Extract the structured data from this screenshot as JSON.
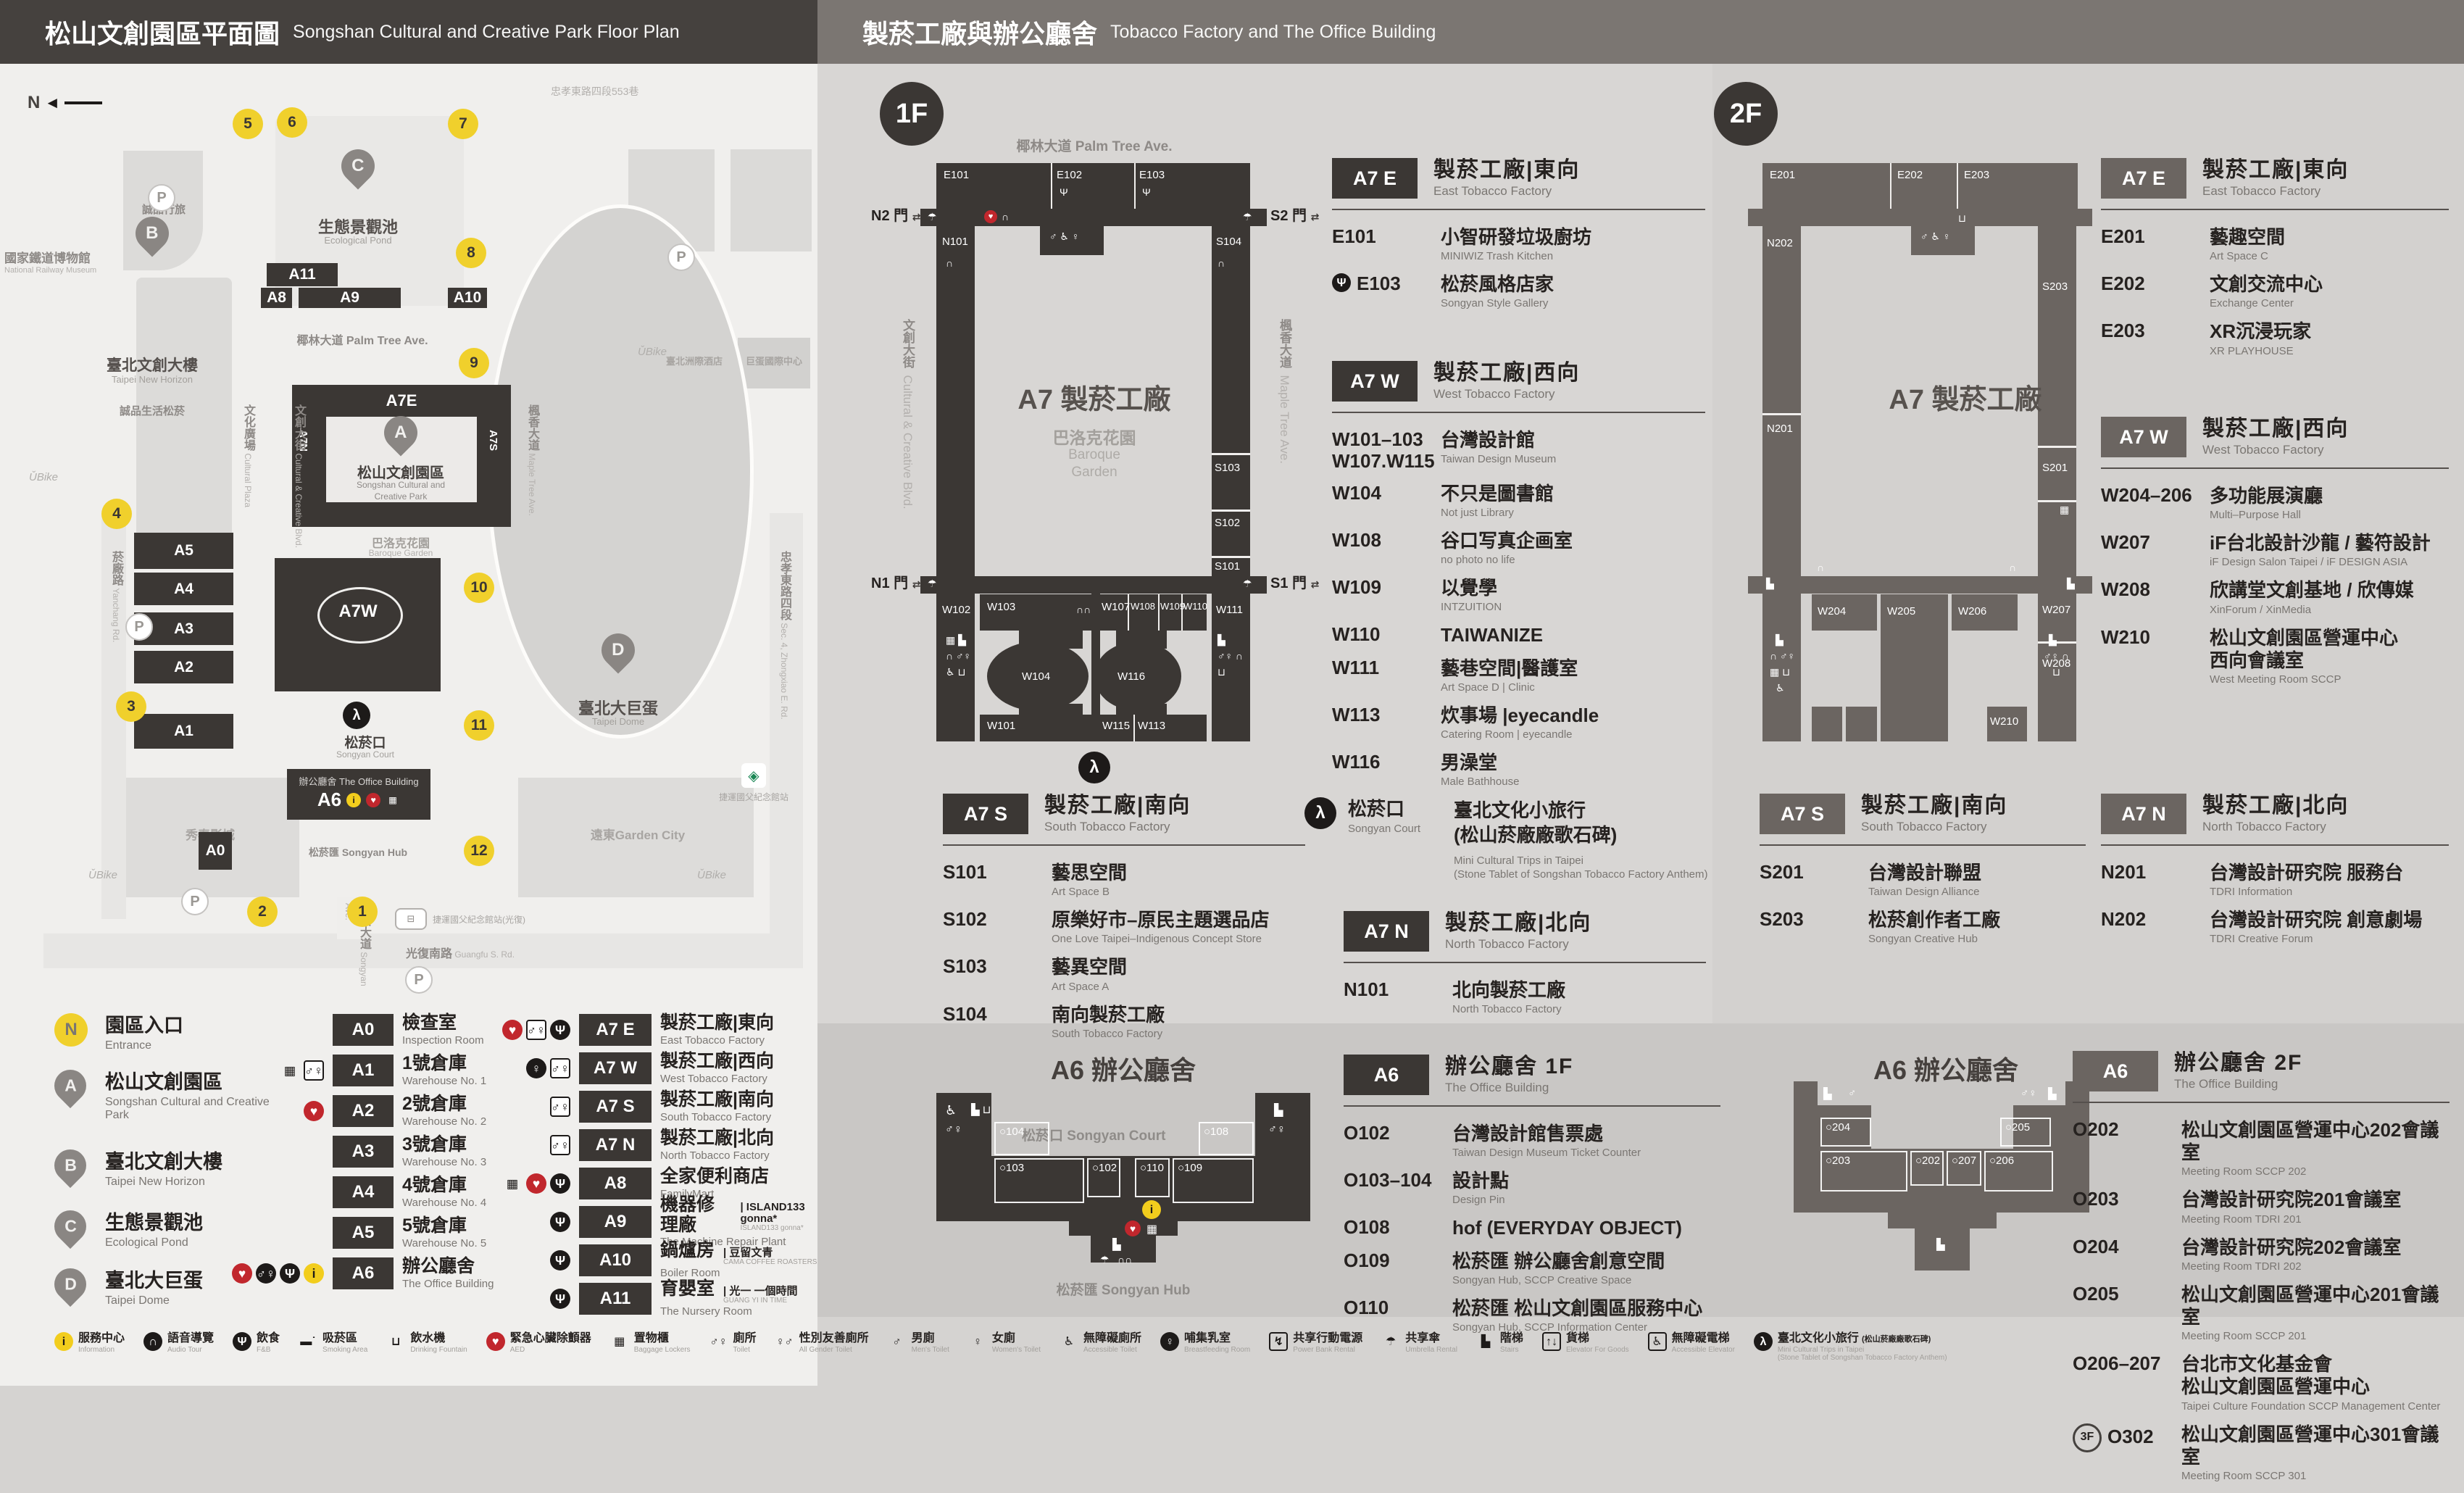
{
  "header_left": {
    "zh": "松山文創園區平面圖",
    "en": "Songshan Cultural and Creative Park Floor Plan"
  },
  "header_right": {
    "zh": "製菸工廠與辦公廳舍",
    "en": "Tobacco Factory and The Office Building"
  },
  "park_map": {
    "compass": "N",
    "entrances": [
      "1",
      "2",
      "3",
      "4",
      "5",
      "6",
      "7",
      "8",
      "9",
      "10",
      "11",
      "12"
    ],
    "buildings": [
      "A0",
      "A1",
      "A2",
      "A3",
      "A4",
      "A5",
      "A8",
      "A9",
      "A10",
      "A11"
    ],
    "labels": {
      "a7e": "A7E",
      "a7w": "A7W",
      "a6": "A6",
      "a7n": "A7N",
      "a7s": "A7S",
      "palm": "椰林大道 Palm Tree Ave.",
      "park_zh": "松山文創園區",
      "park_en1": "Songshan Cultural and",
      "park_en2": "Creative Park",
      "garden_zh": "巴洛克花園",
      "garden_en": "Baroque Garden",
      "court_zh": "松菸口",
      "court_en": "Songyan Court",
      "office_zh": "辦公廳舍",
      "office_en": "The Office Building",
      "hub_zh": "松菸匯",
      "hub_en": "Songyan Hub",
      "pond_zh": "生態景觀池",
      "pond_en": "Ecological Pond",
      "dome_zh": "臺北大巨蛋",
      "dome_en": "Taipei Dome",
      "new_horizon_zh": "臺北文創大樓",
      "new_horizon_en": "Taipei New Horizon",
      "eslite_spectrum": "誠品生活松菸",
      "eslite_hotel": "誠品行旅",
      "railway_zh": "國家鐵道博物館",
      "railway_en": "National Railway Museum",
      "intercontinental": "臺北洲際酒店",
      "dome_intl": "巨蛋國際中心",
      "showtime": "秀泰影城",
      "garden_city": "遠東Garden City",
      "mrt": "捷運國父紀念館站",
      "bus": "捷運國父紀念館站(光復)",
      "lane553": "忠孝東路四段553巷"
    },
    "streets": [
      {
        "zh": "菸廠路",
        "en": "Yanchang Rd."
      },
      {
        "zh": "文化廣場",
        "en": "Cultural Plaza"
      },
      {
        "zh": "文創大街",
        "en": "Cultural & Creative Blvd."
      },
      {
        "zh": "楓香大道",
        "en": "Maple Tree Ave."
      },
      {
        "zh": "松菸大道",
        "en": "Songyan Ave."
      },
      {
        "zh": "光復南路",
        "en": "Guangfu S. Rd."
      },
      {
        "zh": "忠孝東路四段",
        "en": "Sec. 4, Zhongxiao E. Rd."
      }
    ]
  },
  "legend": {
    "places": [
      {
        "sym": "N",
        "zh": "園區入口",
        "en": "Entrance"
      },
      {
        "sym": "A",
        "zh": "松山文創園區",
        "en": "Songshan Cultural and Creative Park"
      },
      {
        "sym": "B",
        "zh": "臺北文創大樓",
        "en": "Taipei New Horizon"
      },
      {
        "sym": "C",
        "zh": "生態景觀池",
        "en": "Ecological Pond"
      },
      {
        "sym": "D",
        "zh": "臺北大巨蛋",
        "en": "Taipei Dome"
      }
    ],
    "col2": [
      {
        "tile": "A0",
        "zh": "檢查室",
        "en": "Inspection Room",
        "icons": []
      },
      {
        "tile": "A1",
        "zh": "1號倉庫",
        "en": "Warehouse No. 1",
        "icons": [
          "lockers",
          "toilet"
        ]
      },
      {
        "tile": "A2",
        "zh": "2號倉庫",
        "en": "Warehouse No. 2",
        "icons": [
          "aed"
        ]
      },
      {
        "tile": "A3",
        "zh": "3號倉庫",
        "en": "Warehouse No. 3",
        "icons": []
      },
      {
        "tile": "A4",
        "zh": "4號倉庫",
        "en": "Warehouse No. 4",
        "icons": []
      },
      {
        "tile": "A5",
        "zh": "5號倉庫",
        "en": "Warehouse No. 5",
        "icons": []
      },
      {
        "tile": "A6",
        "zh": "辦公廳舍",
        "en": "The Office Building",
        "icons": [
          "aed",
          "toiletDark",
          "fnb",
          "info"
        ]
      }
    ],
    "col3": [
      {
        "tile": "A7 E",
        "zh": "製菸工廠|東向",
        "en": "East Tobacco Factory",
        "icons": [
          "aed",
          "toilet",
          "fnb"
        ]
      },
      {
        "tile": "A7 W",
        "zh": "製菸工廠|西向",
        "en": "West Tobacco Factory",
        "icons": [
          "breastfeeding",
          "toilet"
        ]
      },
      {
        "tile": "A7 S",
        "zh": "製菸工廠|南向",
        "en": "South Tobacco Factory",
        "icons": [
          "toilet"
        ]
      },
      {
        "tile": "A7 N",
        "zh": "製菸工廠|北向",
        "en": "North Tobacco Factory",
        "icons": [
          "toilet"
        ]
      },
      {
        "tile": "A8",
        "zh": "全家便利商店",
        "en": "FamilyMart",
        "icons": [
          "lockers",
          "aed",
          "fnb"
        ]
      },
      {
        "tile": "A9",
        "zh": "機器修理廠",
        "en": "The Machine Repair Plant",
        "partner_zh": "ISLAND133 gonna*",
        "partner_en": "ISLAND133 gonna*",
        "icons": [
          "fnb"
        ]
      },
      {
        "tile": "A10",
        "zh": "鍋爐房",
        "en": "Boiler Room",
        "partner_zh": "豆留文青",
        "partner_en": "CAMA COFFEE ROASTERS",
        "icons": [
          "fnb"
        ]
      },
      {
        "tile": "A11",
        "zh": "育嬰室",
        "en": "The Nursery Room",
        "partner_zh": "光一 一個時間",
        "partner_en": "GUANG YI IN TIME",
        "icons": [
          "fnb"
        ]
      }
    ]
  },
  "floor1": {
    "badge": "1F",
    "map": {
      "street_top": "椰林大道 Palm Tree Ave.",
      "street_left_zh": "文創大街",
      "street_left_en": "Cultural & Creative Blvd.",
      "street_right_zh": "楓香大道",
      "street_right_en": "Maple Tree Ave.",
      "center": "A7 製菸工廠",
      "garden_zh": "巴洛克花園",
      "garden_en1": "Baroque",
      "garden_en2": "Garden",
      "gates": [
        "N2 門",
        "S2 門",
        "N1 門",
        "S1 門"
      ],
      "rooms": [
        "E101",
        "E102",
        "E103",
        "N101",
        "W102",
        "S104",
        "S103",
        "S102",
        "S101",
        "W111",
        "W103",
        "W104",
        "W101",
        "W107",
        "W108",
        "W109",
        "W110",
        "W116",
        "W115",
        "W113"
      ]
    },
    "sections": {
      "a7e": {
        "tile": "A7 E",
        "zh": "製菸工廠|東向",
        "en": "East Tobacco Factory",
        "rooms": [
          {
            "code": "E101",
            "zh": "小智研發垃圾廚坊",
            "en": "MINIWIZ Trash Kitchen"
          },
          {
            "code": "E103",
            "zh": "松菸風格店家",
            "en": "Songyan Style Gallery",
            "icon": "fnb"
          }
        ]
      },
      "a7w": {
        "tile": "A7 W",
        "zh": "製菸工廠|西向",
        "en": "West Tobacco Factory",
        "rooms": [
          {
            "code": "W101–103",
            "code2": "W107.W115",
            "zh": "台灣設計館",
            "en": "Taiwan Design Museum"
          },
          {
            "code": "W104",
            "zh": "不只是圖書館",
            "en": "Not just Library"
          },
          {
            "code": "W108",
            "zh": "谷口写真企画室",
            "en": "no photo no life"
          },
          {
            "code": "W109",
            "zh": "以覺學",
            "en": "INTZUITION"
          },
          {
            "code": "W110",
            "zh": "TAIWANIZE",
            "en": ""
          },
          {
            "code": "W111",
            "zh": "藝巷空間|醫護室",
            "en": "Art Space D | Clinic"
          },
          {
            "code": "W113",
            "zh": "炊事場 |eyecandle",
            "en": "Catering Room | eyecandle"
          },
          {
            "code": "W116",
            "zh": "男澡堂",
            "en": "Male Bathhouse"
          }
        ]
      },
      "a7s": {
        "tile": "A7 S",
        "zh": "製菸工廠|南向",
        "en": "South Tobacco Factory",
        "rooms": [
          {
            "code": "S101",
            "zh": "藝思空間",
            "en": "Art Space B"
          },
          {
            "code": "S102",
            "zh": "原樂好市–原民主題選品店",
            "en": "One Love Taipei–Indigenous Concept Store"
          },
          {
            "code": "S103",
            "zh": "藝異空間",
            "en": "Art Space A"
          },
          {
            "code": "S104",
            "zh": "南向製菸工廠",
            "en": "South Tobacco Factory"
          }
        ]
      },
      "court": {
        "zh": "松菸口",
        "en": "Songyan Court",
        "title1": "臺北文化小旅行",
        "title2": "(松山菸廠廠歌石碑)",
        "en1": "Mini Cultural Trips in Taipei",
        "en2": "(Stone Tablet of Songshan Tobacco Factory Anthem)"
      },
      "a7n": {
        "tile": "A7 N",
        "zh": "製菸工廠|北向",
        "en": "North Tobacco Factory",
        "rooms": [
          {
            "code": "N101",
            "zh": "北向製菸工廠",
            "en": "North Tobacco Factory"
          }
        ]
      },
      "a6": {
        "tile": "A6",
        "zh": "辦公廳舍 1F",
        "en": "The Office Building",
        "rooms": [
          {
            "code": "O102",
            "zh": "台灣設計館售票處",
            "en": "Taiwan Design Museum Ticket Counter"
          },
          {
            "code": "O103–104",
            "zh": "設計點",
            "en": "Design Pin"
          },
          {
            "code": "O108",
            "zh": "hof (EVERYDAY OBJECT)",
            "en": ""
          },
          {
            "code": "O109",
            "zh": "松菸匯 辦公廳舍創意空間",
            "en": "Songyan Hub, SCCP Creative Space"
          },
          {
            "code": "O110",
            "zh": "松菸匯 松山文創園區服務中心",
            "en": "Songyan Hub, SCCP Information Center"
          }
        ]
      }
    },
    "a6map": {
      "title": "A6 辦公廳舍",
      "court": "松菸口 Songyan Court",
      "hub": "松菸匯 Songyan Hub",
      "rooms": [
        "O104",
        "O103",
        "O102",
        "O110",
        "O109",
        "O108"
      ]
    }
  },
  "floor2": {
    "badge": "2F",
    "map": {
      "center": "A7 製菸工廠",
      "rooms": [
        "E201",
        "E202",
        "E203",
        "N202",
        "N201",
        "S203",
        "S201",
        "W204",
        "W205",
        "W206",
        "W207",
        "W208",
        "W210"
      ]
    },
    "sections": {
      "a7e": {
        "tile": "A7 E",
        "zh": "製菸工廠|東向",
        "en": "East Tobacco Factory",
        "rooms": [
          {
            "code": "E201",
            "zh": "藝趣空間",
            "en": "Art Space C"
          },
          {
            "code": "E202",
            "zh": "文創交流中心",
            "en": "Exchange Center"
          },
          {
            "code": "E203",
            "zh": "XR沉浸玩家",
            "en": "XR PLAYHOUSE"
          }
        ]
      },
      "a7w": {
        "tile": "A7 W",
        "zh": "製菸工廠|西向",
        "en": "West Tobacco Factory",
        "rooms": [
          {
            "code": "W204–206",
            "zh": "多功能展演廳",
            "en": "Multi–Purpose Hall"
          },
          {
            "code": "W207",
            "zh": "iF台北設計沙龍 / 藝符設計",
            "en": "iF Design Salon Taipei / iF DESIGN ASIA"
          },
          {
            "code": "W208",
            "zh": "欣講堂文創基地 / 欣傳媒",
            "en": "XinForum / XinMedia"
          },
          {
            "code": "W210",
            "zh": "松山文創園區營運中心",
            "zh2": "西向會議室",
            "en": "West Meeting Room SCCP"
          }
        ]
      },
      "a7s": {
        "tile": "A7 S",
        "zh": "製菸工廠|南向",
        "en": "South Tobacco Factory",
        "rooms": [
          {
            "code": "S201",
            "zh": "台灣設計聯盟",
            "en": "Taiwan Design Alliance"
          },
          {
            "code": "S203",
            "zh": "松菸創作者工廠",
            "en": "Songyan Creative Hub"
          }
        ]
      },
      "a7n": {
        "tile": "A7 N",
        "zh": "製菸工廠|北向",
        "en": "North Tobacco Factory",
        "rooms": [
          {
            "code": "N201",
            "zh": "台灣設計研究院 服務台",
            "en": "TDRI Information"
          },
          {
            "code": "N202",
            "zh": "台灣設計研究院 創意劇場",
            "en": "TDRI Creative Forum"
          }
        ]
      },
      "a6": {
        "tile": "A6",
        "zh": "辦公廳舍 2F",
        "en": "The Office Building",
        "rooms": [
          {
            "code": "O202",
            "zh": "松山文創園區營運中心202會議室",
            "en": "Meeting Room SCCP 202"
          },
          {
            "code": "O203",
            "zh": "台灣設計研究院201會議室",
            "en": "Meeting Room TDRI 201"
          },
          {
            "code": "O204",
            "zh": "台灣設計研究院202會議室",
            "en": "Meeting Room TDRI 202"
          },
          {
            "code": "O205",
            "zh": "松山文創園區營運中心201會議室",
            "en": "Meeting Room SCCP 201"
          },
          {
            "code": "O206–207",
            "zh": "台北市文化基金會",
            "zh2": "松山文創園區營運中心",
            "en": "Taipei Culture Foundation SCCP Management Center"
          },
          {
            "code": "O302",
            "badge": "3F",
            "zh": "松山文創園區營運中心301會議室",
            "en": "Meeting Room SCCP 301"
          }
        ]
      }
    },
    "a6map": {
      "title": "A6 辦公廳舍",
      "rooms": [
        "O204",
        "O203",
        "O202",
        "O207",
        "O206",
        "O205"
      ]
    }
  },
  "footer": [
    {
      "icon": "info",
      "zh": "服務中心",
      "en": "Information"
    },
    {
      "icon": "audio",
      "zh": "語音導覽",
      "en": "Audio Tour"
    },
    {
      "icon": "fnb",
      "zh": "飲食",
      "en": "F&B"
    },
    {
      "icon": "smoking",
      "zh": "吸菸區",
      "en": "Smoking Area"
    },
    {
      "icon": "fountain",
      "zh": "飲水機",
      "en": "Drinking Fountain"
    },
    {
      "icon": "aed",
      "zh": "緊急心臟除顫器",
      "en": "AED"
    },
    {
      "icon": "lockers",
      "zh": "置物櫃",
      "en": "Baggage Lockers"
    },
    {
      "icon": "toiletP",
      "zh": "廁所",
      "en": "Toilet"
    },
    {
      "icon": "allgender",
      "zh": "性別友善廁所",
      "en": "All Gender Toilet"
    },
    {
      "icon": "men",
      "zh": "男廁",
      "en": "Men's Toilet"
    },
    {
      "icon": "women",
      "zh": "女廁",
      "en": "Women's Toilet"
    },
    {
      "icon": "accessible",
      "zh": "無障礙廁所",
      "en": "Accessible Toilet"
    },
    {
      "icon": "breastfeeding",
      "zh": "哺集乳室",
      "en": "Breastfeeding Room"
    },
    {
      "icon": "powerbank",
      "zh": "共享行動電源",
      "en": "Power Bank Rental"
    },
    {
      "icon": "umbrella",
      "zh": "共享傘",
      "en": "Umbrella Rental"
    },
    {
      "icon": "stairs",
      "zh": "階梯",
      "en": "Stairs"
    },
    {
      "icon": "goodslift",
      "zh": "貨梯",
      "en": "Elevator For Goods"
    },
    {
      "icon": "acclift",
      "zh": "無障礙電梯",
      "en": "Accessible Elevator"
    },
    {
      "icon": "trips",
      "zh": "臺北文化小旅行",
      "zh2": "(松山菸廠廠歌石碑)",
      "en": "Mini Cultural Trips in Taipei",
      "en2": "(Stone Tablet of Songshan Tobacco Factory Anthem)"
    }
  ]
}
